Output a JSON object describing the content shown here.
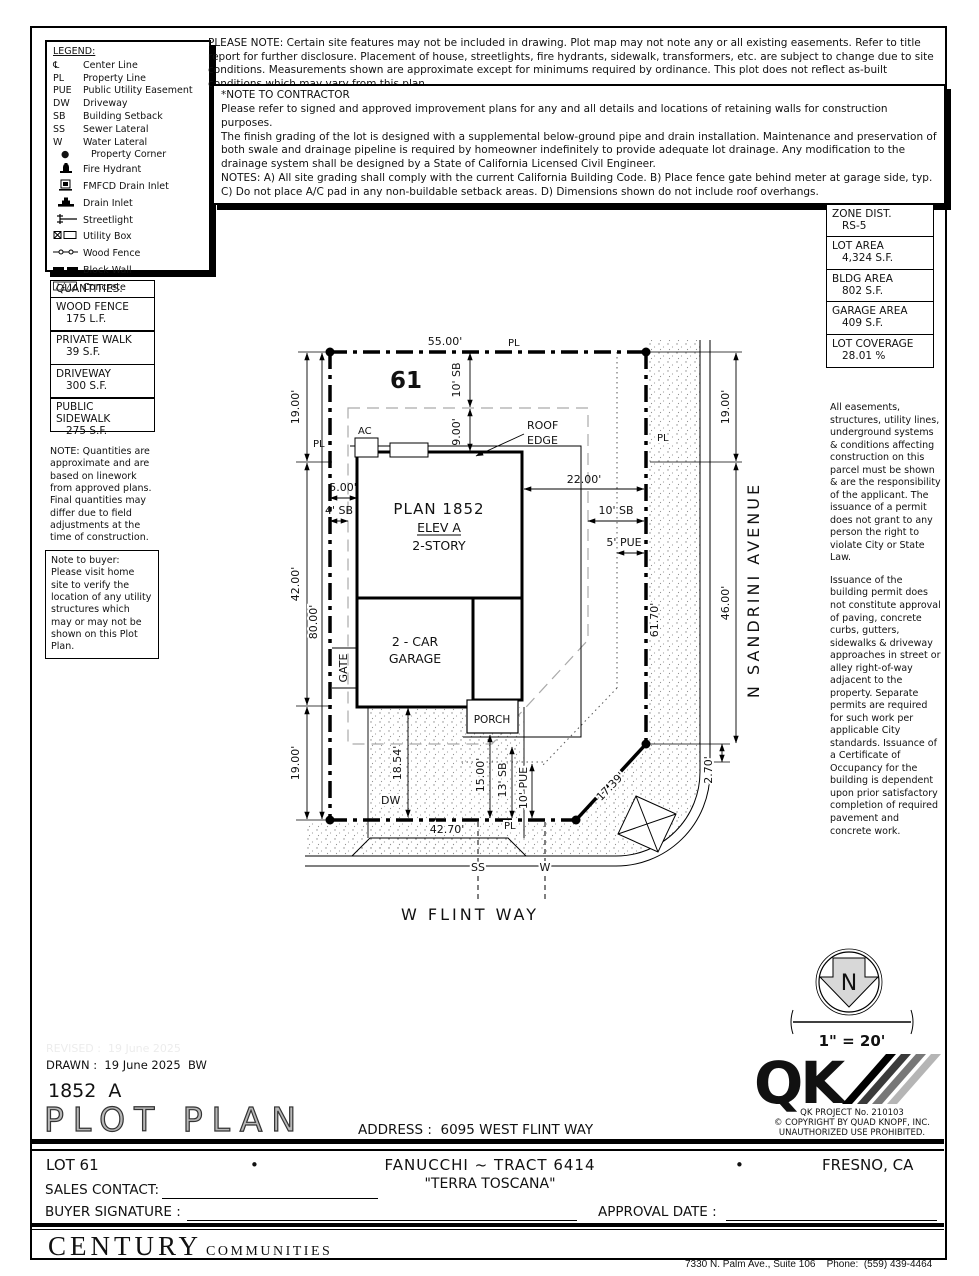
{
  "legend": {
    "title": "LEGEND:",
    "items": [
      {
        "symbol": "℄",
        "icon": "centerline-symbol",
        "label": "Center Line"
      },
      {
        "symbol": "PL",
        "icon": "property-line-symbol",
        "label": "Property Line"
      },
      {
        "symbol": "PUE",
        "icon": "pue-symbol",
        "label": "Public Utility Easement"
      },
      {
        "symbol": "DW",
        "icon": "driveway-symbol",
        "label": "Driveway"
      },
      {
        "symbol": "SB",
        "icon": "setback-symbol",
        "label": "Building Setback"
      },
      {
        "symbol": "SS",
        "icon": "sewer-symbol",
        "label": "Sewer Lateral"
      },
      {
        "symbol": "W",
        "icon": "water-symbol",
        "label": "Water Lateral"
      },
      {
        "symbol": "●",
        "icon": "property-corner-icon",
        "label": "Property Corner"
      },
      {
        "symbol": "",
        "icon": "fire-hydrant-icon",
        "label": "Fire Hydrant"
      },
      {
        "symbol": "",
        "icon": "fmfcd-drain-inlet-icon",
        "label": "FMFCD Drain Inlet"
      },
      {
        "symbol": "",
        "icon": "drain-inlet-icon",
        "label": "Drain Inlet"
      },
      {
        "symbol": "",
        "icon": "streetlight-icon",
        "label": "Streetlight"
      },
      {
        "symbol": "",
        "icon": "utility-box-icon",
        "label": "Utility Box"
      },
      {
        "symbol": "",
        "icon": "wood-fence-icon",
        "label": "Wood Fence"
      },
      {
        "symbol": "",
        "icon": "block-wall-icon",
        "label": "Block Wall"
      },
      {
        "symbol": "",
        "icon": "concrete-icon",
        "label": "Concrete"
      }
    ]
  },
  "notes": {
    "please_note": "PLEASE NOTE:  Certain site features may not be included in drawing.  Plot map may not note any or all existing easements. Refer to title report for further disclosure.  Placement of house, streetlights, fire hydrants, sidewalk, transformers, etc. are subject to change due to site conditions.  Measurements shown are approximate except for minimums required by ordinance.  This plot does not reflect as-built conditions which may vary from this plan.",
    "contractor": {
      "heading": "*NOTE TO CONTRACTOR",
      "p1": "Please refer to signed and approved improvement plans for any and all details and locations of retaining walls for construction purposes.",
      "p2": "The finish grading of the lot is designed with a supplemental below-ground pipe and drain installation.  Maintenance and preservation of both swale and drainage pipeline is required by homeowner indefinitely to provide adequate lot drainage.  Any modification to the drainage system shall be designed by a State of California Licensed Civil Engineer.",
      "p3": "NOTES:  A) All site grading shall comply with the current California Building Code.  B) Place fence gate behind meter at garage side, typ.  C) Do not place A/C pad in any non-buildable setback areas.  D) Dimensions shown do not include roof overhangs."
    },
    "quantities_note": "NOTE: Quantities are approximate and are based on linework from approved plans.  Final quantities may differ due to field adjustments at the time of construction.",
    "buyer_note": "Note to buyer: Please visit home site to verify the location of any utility structures which may or may not be shown on this Plot Plan.",
    "right_col": {
      "p1": "All easements, structures, utility lines, underground systems & conditions affecting construction on this parcel must be shown & are the responsibility of the applicant. The issuance of a permit does not grant to any person the right to violate City or State Law.",
      "p2": "Issuance of the building permit does not constitute approval of paving, concrete curbs, gutters, sidewalks & driveway approaches in street or alley right-of-way adjacent to the property. Separate permits are required for such work per applicable City standards. Issuance of a Certificate of Occupancy for the building is dependent upon prior satisfactory completion of required pavement and concrete work."
    }
  },
  "zone_table": {
    "rows": [
      {
        "label": "ZONE DIST.",
        "value": "RS-5"
      },
      {
        "label": "LOT AREA",
        "value": "4,324 S.F."
      },
      {
        "label": "BLDG AREA",
        "value": "802 S.F."
      },
      {
        "label": "GARAGE AREA",
        "value": "409 S.F."
      },
      {
        "label": "LOT COVERAGE",
        "value": "28.01 %"
      }
    ]
  },
  "quantities": {
    "title": "QUANTITIES:",
    "rows": [
      {
        "label": "WOOD FENCE",
        "value": "175 L.F."
      },
      {
        "label": "PRIVATE WALK",
        "value": "39 S.F."
      },
      {
        "label": "DRIVEWAY",
        "value": "300 S.F."
      },
      {
        "label": "PUBLIC SIDEWALK",
        "value": "275 S.F."
      }
    ]
  },
  "plot": {
    "lot_number": "61",
    "pl": "PL",
    "dim_top": "55.00'",
    "sb10_top": "10' SB",
    "dim9": "9.00'",
    "roof_edge_1": "ROOF",
    "roof_edge_2": "EDGE",
    "ac": "AC",
    "dim5": "5.00'",
    "sb4": "4' SB",
    "plan_name": "PLAN 1852",
    "plan_elev": "ELEV A",
    "plan_story": "2-STORY",
    "dim22": "22.00'",
    "sb10_right": "10' SB",
    "pue5": "5' PUE",
    "left19a": "19.00'",
    "left42": "42.00'",
    "left19b": "19.00'",
    "left80": "80.00'",
    "right19": "19.00'",
    "right46": "46.00'",
    "right6170": "61.70'",
    "right270": "2.70'",
    "diag1739": "17.39'",
    "gate": "GATE",
    "garage1": "2 - CAR",
    "garage2": "GARAGE",
    "porch": "PORCH",
    "dim1854": "18.54'",
    "dw": "DW",
    "dim4270": "42.70'",
    "dim15": "15.00'",
    "sb13": "13' SB",
    "pue10": "10' PUE",
    "ss": "SS",
    "w": "W",
    "street_bottom": "W FLINT WAY",
    "street_right": "N SANDRINI AVENUE"
  },
  "north": {
    "letter": "N",
    "scale": "1\" = 20'"
  },
  "qk": {
    "logo": "QK",
    "line1": "QK PROJECT No. 210103",
    "line2": "©  COPYRIGHT BY QUAD KNOPF, INC.",
    "line3": "UNAUTHORIZED USE PROHIBITED."
  },
  "titleblock": {
    "revised": "REVISED :  19 June 2025",
    "drawn": "DRAWN :  19 June 2025  BW",
    "plan_code": "1852  A",
    "title": "PLOT PLAN",
    "address_label": "ADDRESS :  ",
    "address_value": "6095 WEST FLINT WAY",
    "lot": "LOT 61",
    "bullet": "•",
    "tract": "FANUCCHI ~ TRACT 6414",
    "community": "\"TERRA TOSCANA\"",
    "city": "FRESNO, CA",
    "sales_label": "SALES CONTACT:",
    "buyer_label": "BUYER SIGNATURE :",
    "approval_label": "APPROVAL DATE :"
  },
  "footer": {
    "brand_main": "CENTURY",
    "brand_sub": "COMMUNITIES",
    "address_line1": "7330 N. Palm Ave., Suite 106    Phone:  (559) 439-4464",
    "address_line2": "Fresno, CA  93711"
  }
}
